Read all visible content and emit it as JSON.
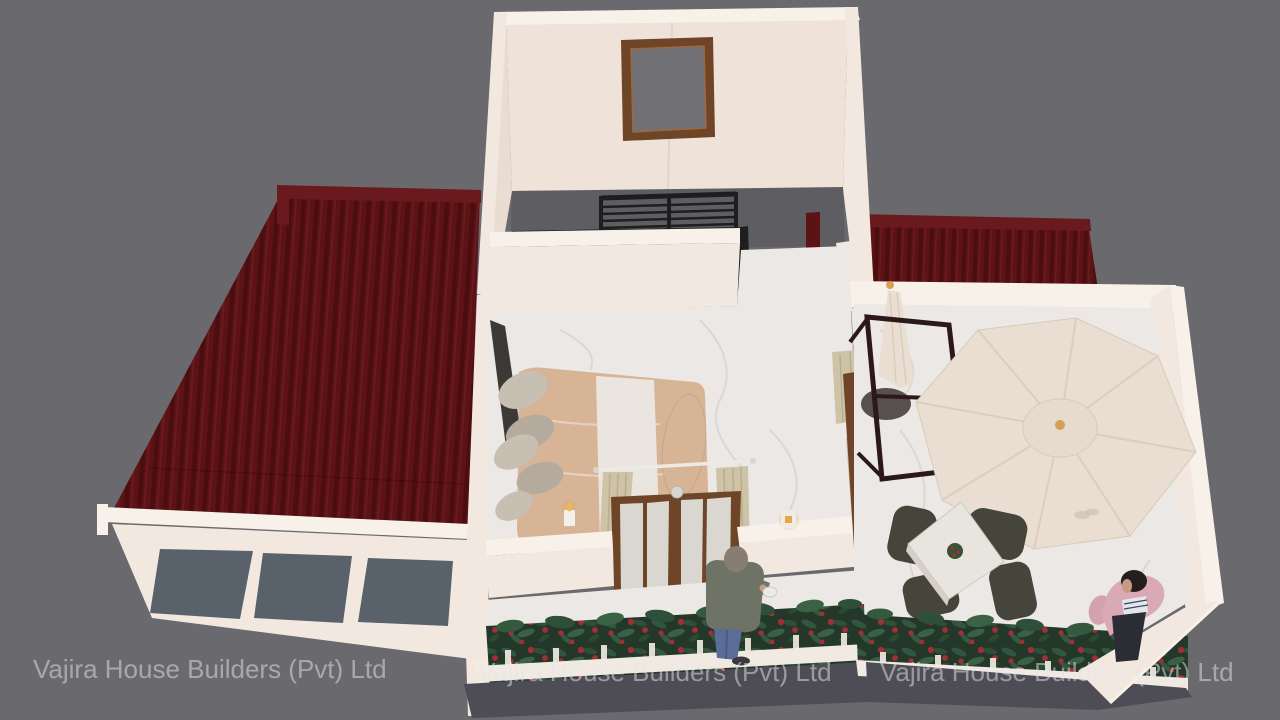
{
  "image": {
    "type": "3d-architectural-render",
    "view": "isometric cutaway of a house upper floor with bedroom, stairwell, roof terrace and front balcony",
    "company": "Vajira House Builders (Pvt) Ltd"
  },
  "watermark": {
    "text": "Vajira House Builders (Pvt) Ltd",
    "count": 3
  },
  "scene": {
    "areas": [
      {
        "name": "stairwell",
        "features": [
          "back-wall window",
          "black stair railing",
          "open wooden door",
          "dark landing floor"
        ]
      },
      {
        "name": "bedroom",
        "features": [
          "double bed with tan duvet and white runner",
          "gray pillows",
          "dark headboard",
          "floor candle",
          "french doors to balcony",
          "beige curtains",
          "wall light"
        ]
      },
      {
        "name": "roof-terrace",
        "features": [
          "open octagonal patio umbrella",
          "closed folded umbrella",
          "dark metal frame stand",
          "round side table",
          "square dining table with centerpiece",
          "four wicker chairs"
        ]
      },
      {
        "name": "front-balcony",
        "features": [
          "marble walkway",
          "flower planter boxes",
          "white railing with posts"
        ]
      },
      {
        "name": "roofs",
        "features": [
          "large red corrugated roof on left",
          "red corrugated roof strip at top right"
        ]
      },
      {
        "name": "lower-facade",
        "features": [
          "cream parapet wall",
          "three dark windows"
        ]
      }
    ],
    "people": [
      {
        "name": "man-on-balcony",
        "description": "man in gray-green jacket and blue jeans holding a white cup"
      },
      {
        "name": "man-on-terrace",
        "description": "man in pink jacket and dark trousers tending planter flowers"
      }
    ]
  },
  "colors": {
    "background": "#6a696d",
    "wall-cream": "#f2e8e0",
    "wall-cream-light": "#f8f1ea",
    "wall-cream-dark": "#e9dcd2",
    "wall-shadow": "#dfd0c5",
    "roof-red": "#5d1215",
    "roof-stripe": "#470d10",
    "roof-cap": "#6a191c",
    "window-glass": "#717075",
    "stair-floor": "#5e5d61",
    "railing-black": "#1e1e20",
    "door-brown": "#6e4526",
    "door-brown-dark": "#54301a",
    "marble": "#ebe8e5",
    "marble-vein": "#d7d3cf",
    "duvet-tan": "#d8b497",
    "sheet-white": "#eae5de",
    "pillow-gray": "#c8bfb3",
    "pillow-gray-dark": "#b4aa9d",
    "headboard": "#3d3937",
    "curtain-beige": "#cec2a7",
    "umbrella-cream": "#e9ded1",
    "umbrella-seam": "#d8cbbb",
    "umbrella-finial": "#d79f55",
    "frame-dark": "#2c181b",
    "chair-dark": "#45453c",
    "table-top": "#e8e4de",
    "plant-dark": "#24382a",
    "plant-light": "#3c6245",
    "flower-red": "#a12f34",
    "fascia-gray": "#4e4d55",
    "facade-window": "#59616b",
    "skin": "#c79b82",
    "jeans-blue": "#5a6d96",
    "jacket-gray": "#6f7366",
    "jacket-pink": "#d9a9b6",
    "pants-dark": "#2c2c34",
    "watermark": "#e8e6ec"
  }
}
